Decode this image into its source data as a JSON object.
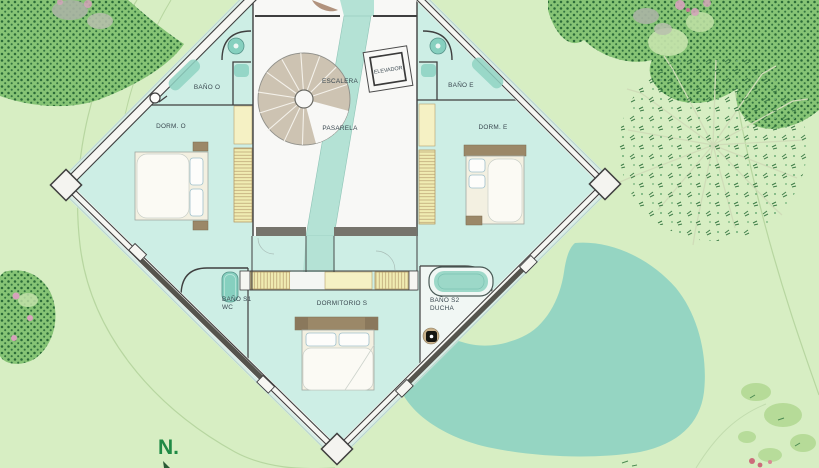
{
  "plan": {
    "labels": {
      "bano_o": "BAÑO O",
      "dorm_o": "DORM. O",
      "escalera": "ESCALERA",
      "elevador": "ELEVADOR",
      "pasarela": "PASARELA",
      "bano_e": "BAÑO E",
      "dorm_e": "DORM. E",
      "bano_s1": "BAÑO S1",
      "bano_s1_sub": "WC",
      "dormitorio_s": "DORMITORIO S",
      "bano_s2": "BAÑO S2",
      "bano_s2_sub": "DUCHA"
    }
  },
  "compass": {
    "north": "N."
  },
  "colors": {
    "background": "#d7eec3",
    "canopy": "#86c475",
    "canopy_dots": "#2b6b38",
    "pond": "#95d5c2",
    "room": "#cdeee5",
    "walkway": "#b4e2d5",
    "floor": "#f8f8f6",
    "wall": "#3f3f3f",
    "wardrobe": "#f0ecb2",
    "fixture": "#86d0bf",
    "furniture_wood": "#9b8868",
    "bed": "#f3f0e1",
    "label": "#3a4850",
    "north": "#1f8a45"
  }
}
